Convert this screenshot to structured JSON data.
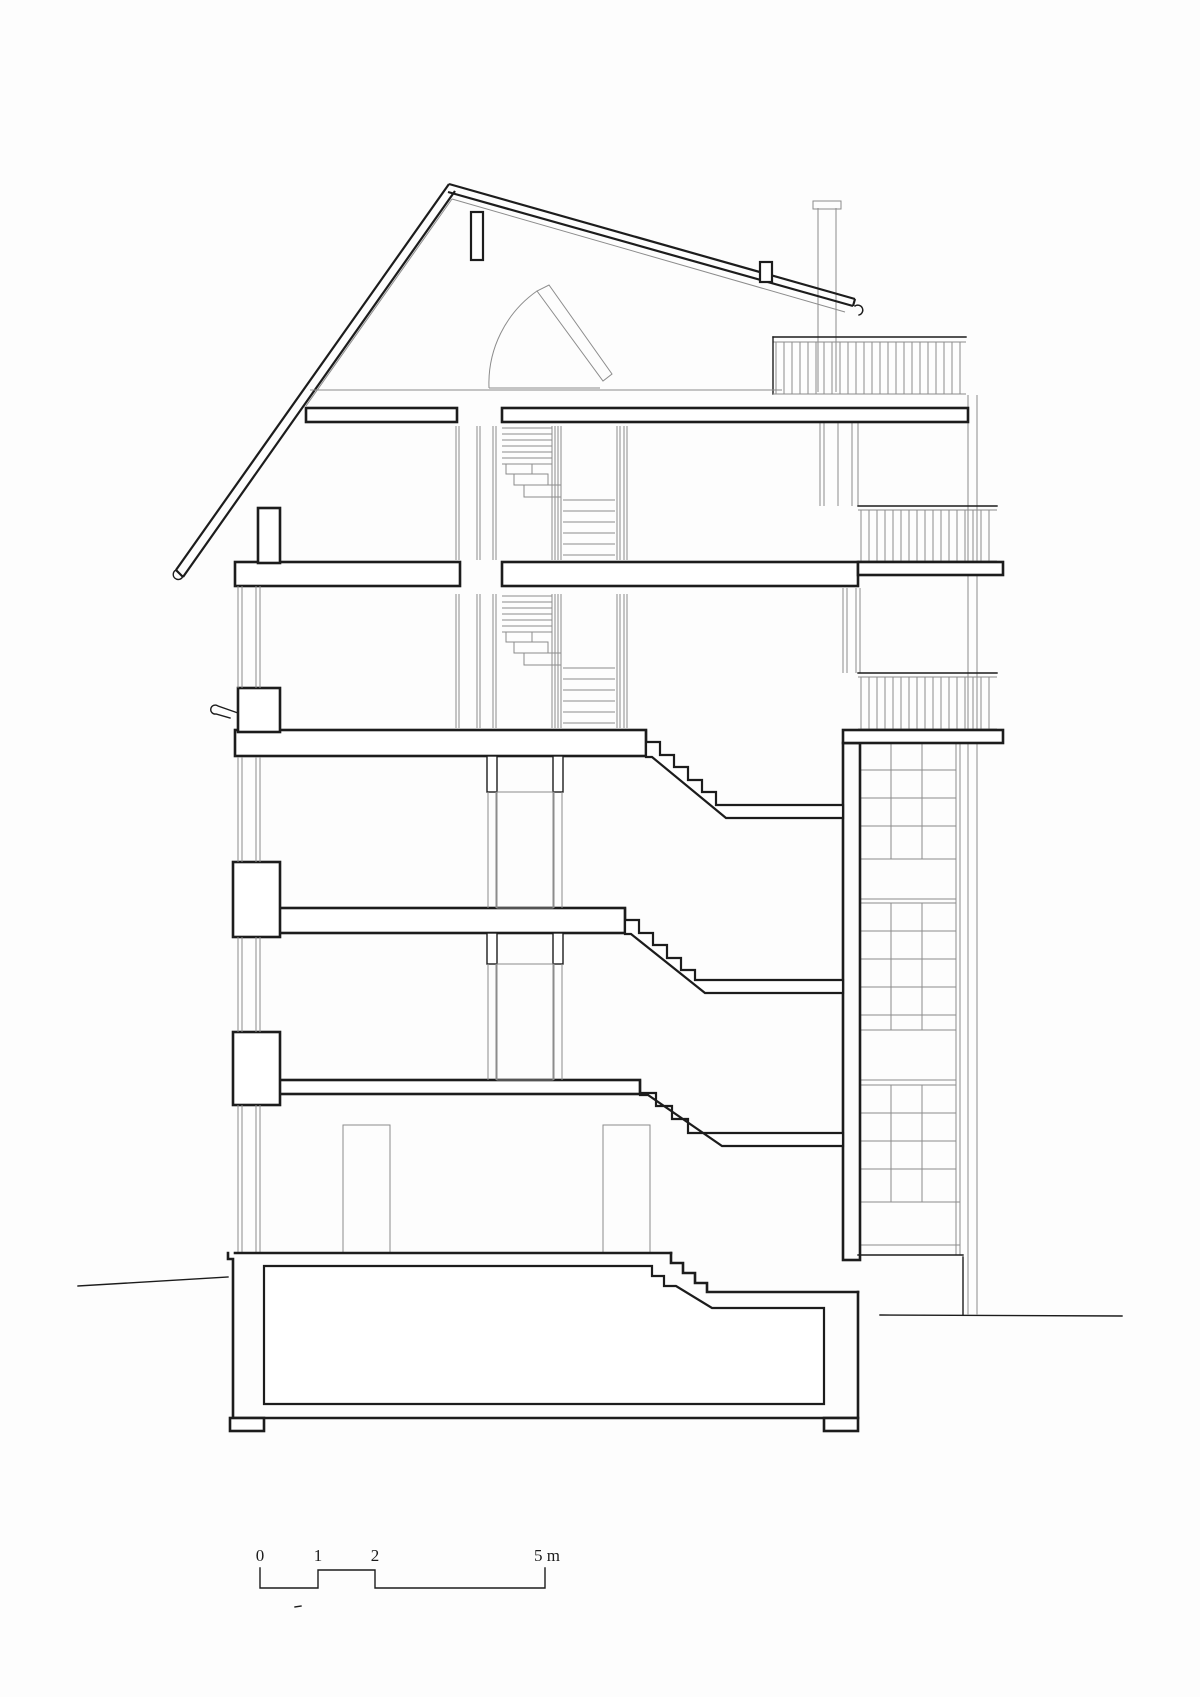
{
  "figure": {
    "kind": "architectural cross-section drawing",
    "storeys_visible": 6,
    "balconies_visible": 3
  },
  "scale_bar": {
    "labels": [
      "0",
      "1",
      "2",
      "5 m"
    ],
    "unit": "m",
    "values": [
      0,
      1,
      2,
      5
    ]
  },
  "colors": {
    "background": "#fdfdfd",
    "ink": "#1c1c1c",
    "faint": "#8c8c8c"
  }
}
